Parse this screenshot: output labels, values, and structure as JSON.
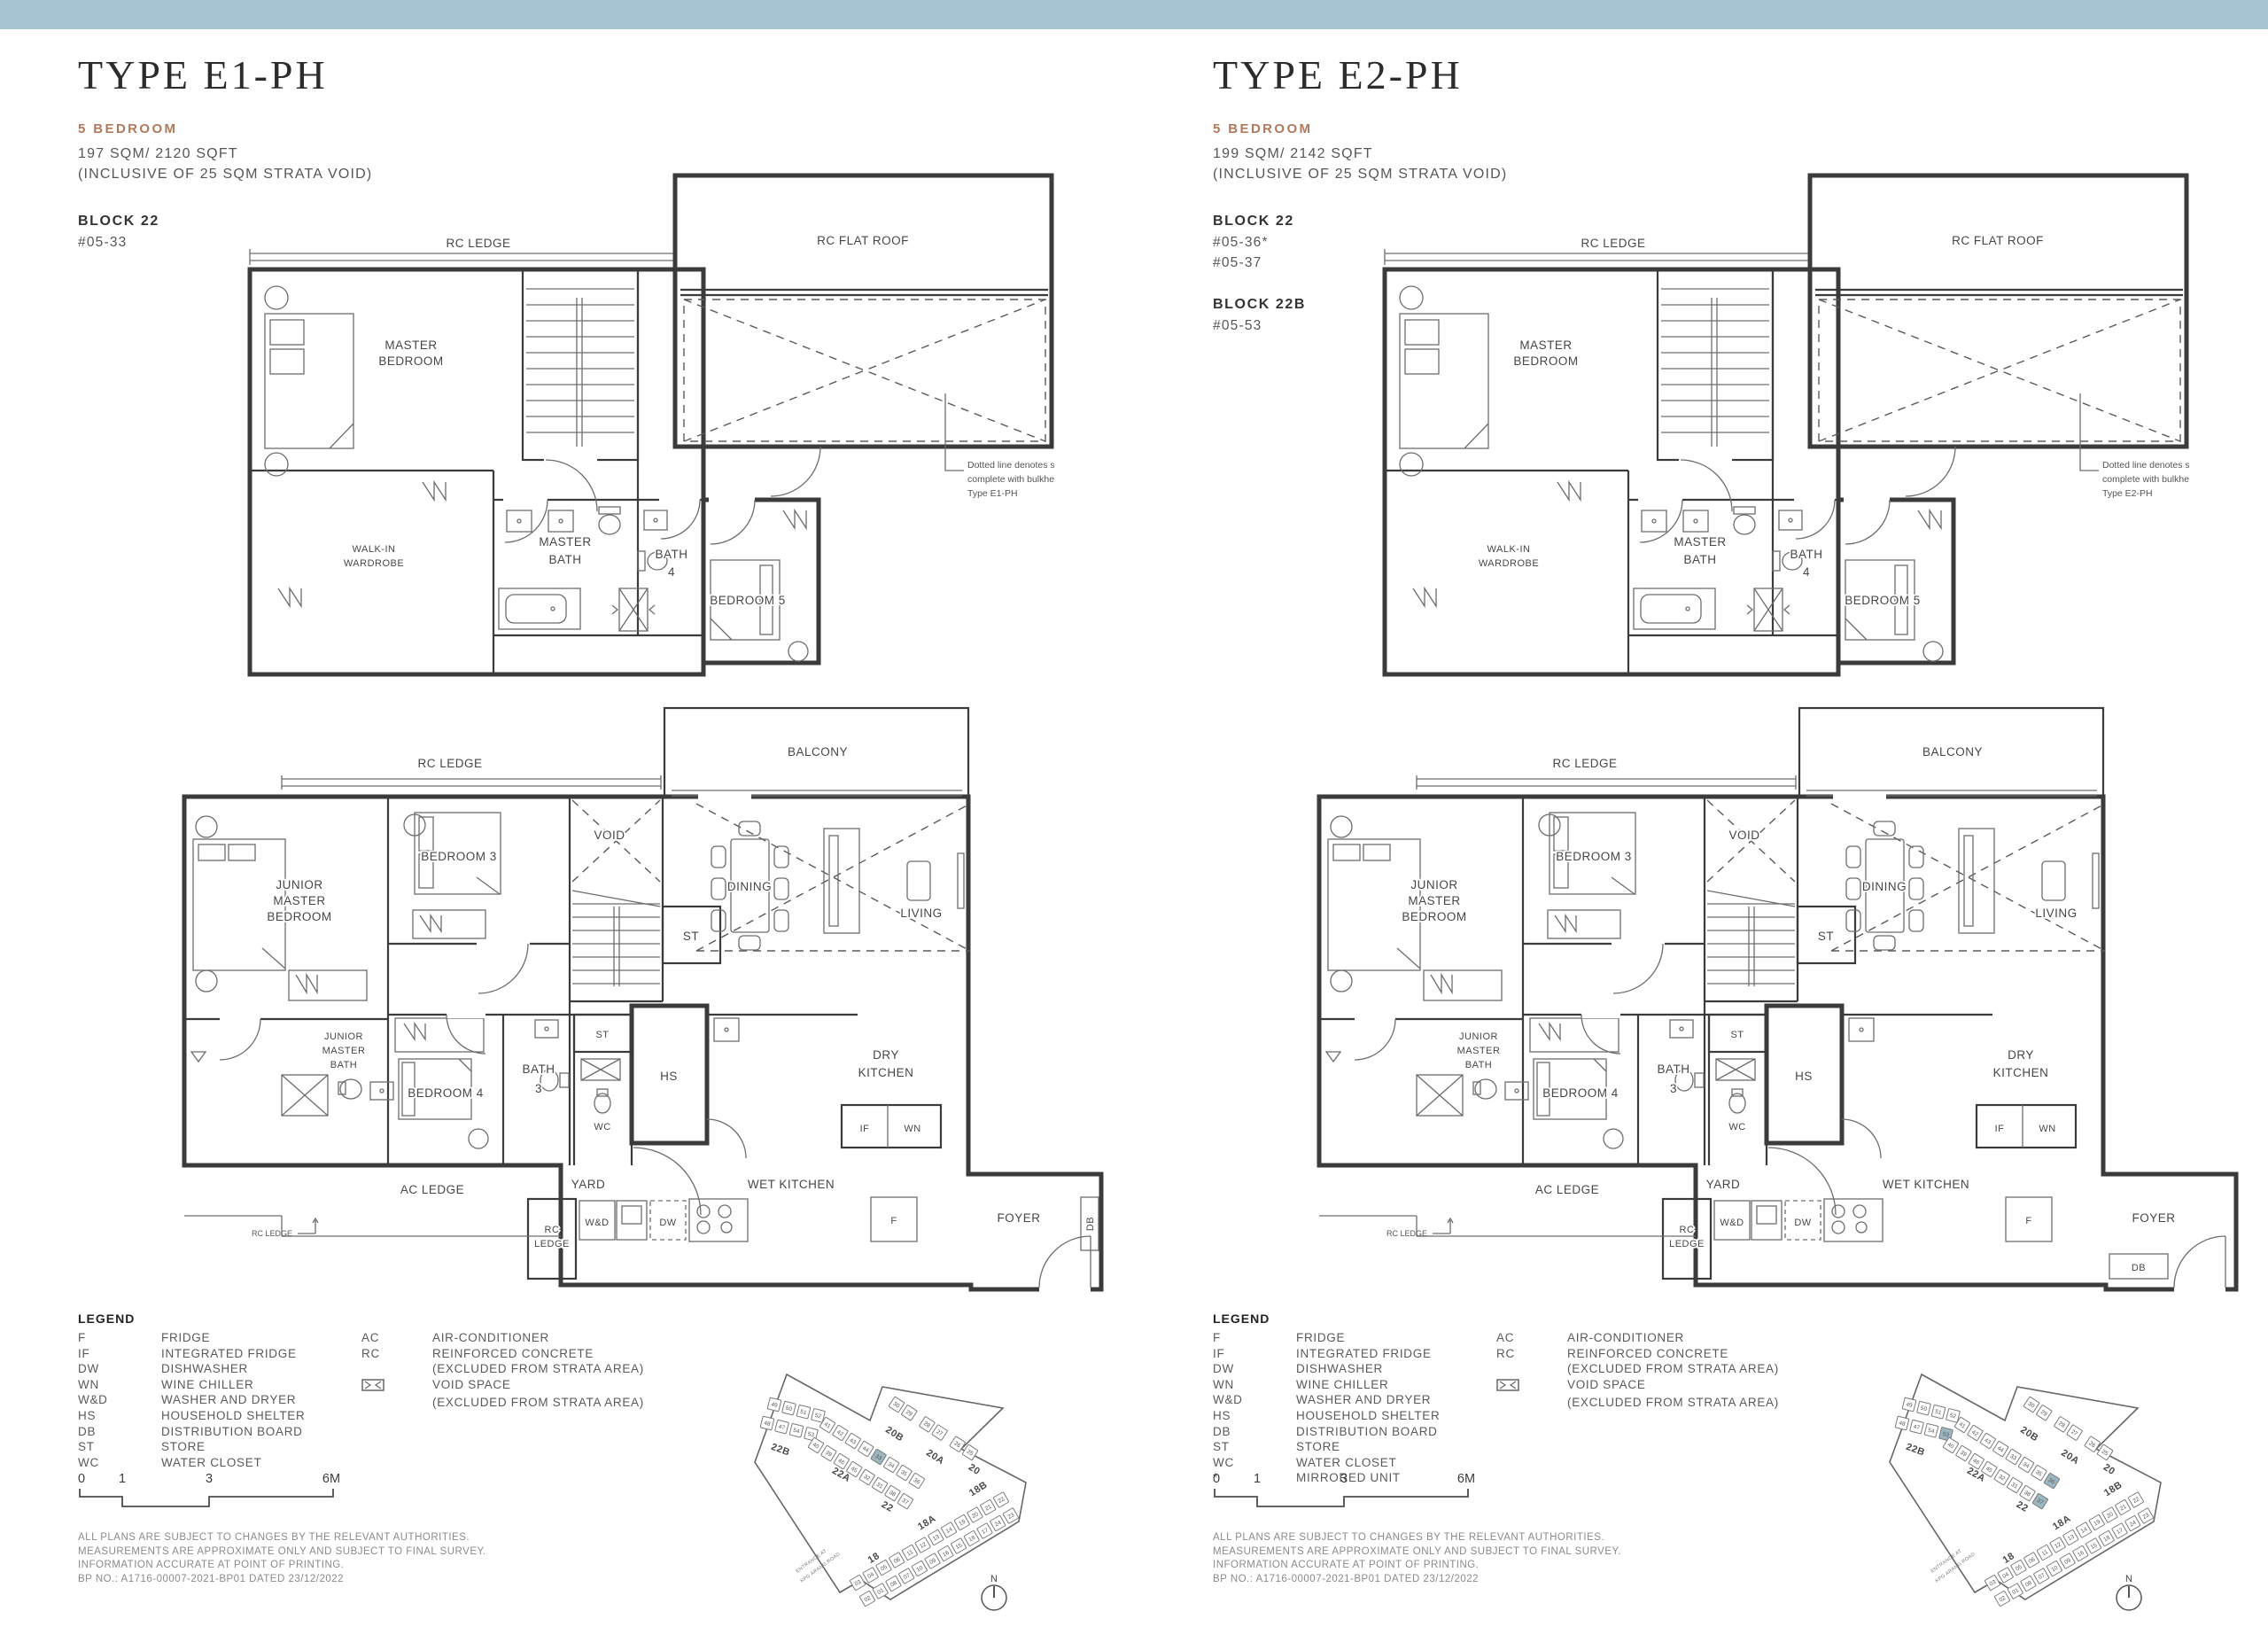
{
  "page": {
    "topbar_color": "#a6c4d2",
    "accent_color": "#b1795b",
    "highlight_color": "#9cb7c1"
  },
  "legend_title": "LEGEND",
  "legend_right": [
    {
      "a": "AC",
      "t": "AIR-CONDITIONER"
    },
    {
      "a": "RC",
      "t": "REINFORCED CONCRETE"
    },
    {
      "a": "",
      "t": "(EXCLUDED FROM STRATA AREA)"
    },
    {
      "a": "",
      "t": "VOID SPACE"
    },
    {
      "a": "",
      "t": "(EXCLUDED FROM STRATA AREA)"
    }
  ],
  "scalebar": [
    "0",
    "1",
    "3",
    "6M"
  ],
  "disclaimer": [
    "ALL PLANS ARE SUBJECT TO CHANGES BY THE RELEVANT AUTHORITIES.",
    "MEASUREMENTS ARE APPROXIMATE ONLY AND SUBJECT TO FINAL SURVEY.",
    "INFORMATION ACCURATE AT POINT OF PRINTING.",
    "BP NO.: A1716-00007-2021-BP01 DATED 23/12/2022"
  ],
  "plan": {
    "upper": {
      "rc_ledge": "RC LEDGE",
      "rc_flat_roof": "RC FLAT ROOF",
      "master_bedroom": [
        "MASTER",
        "BEDROOM"
      ],
      "walk_in_wardrobe": [
        "WALK-IN",
        "WARDROBE"
      ],
      "master_bath": [
        "MASTER",
        "BATH"
      ],
      "bath4": [
        "BATH",
        "4"
      ],
      "bedroom5": "BEDROOM 5"
    },
    "lower": {
      "rc_ledge": "RC LEDGE",
      "balcony": "BALCONY",
      "junior_master_bedroom": [
        "JUNIOR",
        "MASTER",
        "BEDROOM"
      ],
      "bedroom3": "BEDROOM 3",
      "void": "VOID",
      "st_upper": "ST",
      "dining": "DINING",
      "living": "LIVING",
      "junior_master_bath": [
        "JUNIOR",
        "MASTER",
        "BATH"
      ],
      "bedroom4": "BEDROOM 4",
      "bath3": [
        "BATH",
        "3"
      ],
      "st_small": "ST",
      "wc": "WC",
      "hs": "HS",
      "dry_kitchen": [
        "DRY",
        "KITCHEN"
      ],
      "if_label": "IF",
      "wn": "WN",
      "ac_ledge": "AC LEDGE",
      "yard": "YARD",
      "wet_kitchen": "WET KITCHEN",
      "rc_ledge_small": [
        "RC",
        "LEDGE"
      ],
      "rc_ledge_tiny": "RC LEDGE",
      "wd": "W&D",
      "dw": "DW",
      "f": "F",
      "foyer": "FOYER",
      "db": "DB"
    }
  },
  "sitemap": {
    "block_labels": [
      "22B",
      "22A",
      "22",
      "20B",
      "20A",
      "20",
      "18",
      "18A",
      "18B"
    ],
    "stacks": [
      [
        "49",
        "50",
        "51",
        "52"
      ],
      [
        "48",
        "47",
        "54",
        "53"
      ],
      [
        "41",
        "42",
        "43",
        "44",
        "33",
        "34",
        "35",
        "36"
      ],
      [
        "40",
        "39",
        "46",
        "45",
        "32",
        "31",
        "38",
        "37"
      ],
      [
        "30",
        "29",
        "28",
        "27",
        "26",
        "25"
      ],
      [
        "03",
        "04",
        "05",
        "06",
        "11",
        "12",
        "13",
        "14",
        "19",
        "20",
        "21",
        "22"
      ],
      [
        "02",
        "01",
        "08",
        "07",
        "10",
        "09",
        "16",
        "15",
        "18",
        "17",
        "24",
        "23"
      ]
    ],
    "north": "N",
    "entrance": [
      "ENTRANCE AT",
      "KPG ARANG ROAD"
    ]
  },
  "panels": [
    {
      "title": "TYPE E1-PH",
      "bedroom_tag": "5 BEDROOM",
      "area": "197 SQM/ 2120 SQFT",
      "area_note": "(INCLUSIVE OF 25 SQM STRATA VOID)",
      "block1_name": "BLOCK 22",
      "block1_units": [
        "#05-33"
      ],
      "annotation": [
        "Dotted line denotes strata void",
        "complete with bulkhead at",
        "Type E1-PH"
      ],
      "legend_left": [
        {
          "a": "F",
          "t": "FRIDGE"
        },
        {
          "a": "IF",
          "t": "INTEGRATED FRIDGE"
        },
        {
          "a": "DW",
          "t": "DISHWASHER"
        },
        {
          "a": "WN",
          "t": "WINE CHILLER"
        },
        {
          "a": "W&D",
          "t": "WASHER AND DRYER"
        },
        {
          "a": "HS",
          "t": "HOUSEHOLD SHELTER"
        },
        {
          "a": "DB",
          "t": "DISTRIBUTION BOARD"
        },
        {
          "a": "ST",
          "t": "STORE"
        },
        {
          "a": "WC",
          "t": "WATER CLOSET"
        }
      ],
      "sitemap_highlights": [
        "33"
      ]
    },
    {
      "title": "TYPE E2-PH",
      "bedroom_tag": "5 BEDROOM",
      "area": "199 SQM/ 2142 SQFT",
      "area_note": "(INCLUSIVE OF 25 SQM STRATA VOID)",
      "block1_name": "BLOCK 22",
      "block1_units": [
        "#05-36*",
        "#05-37"
      ],
      "block2_name": "BLOCK 22B",
      "block2_units": [
        "#05-53"
      ],
      "annotation": [
        "Dotted line denotes strata void",
        "complete with bulkhead at",
        "Type E2-PH"
      ],
      "legend_left": [
        {
          "a": "F",
          "t": "FRIDGE"
        },
        {
          "a": "IF",
          "t": "INTEGRATED FRIDGE"
        },
        {
          "a": "DW",
          "t": "DISHWASHER"
        },
        {
          "a": "WN",
          "t": "WINE CHILLER"
        },
        {
          "a": "W&D",
          "t": "WASHER AND DRYER"
        },
        {
          "a": "HS",
          "t": "HOUSEHOLD SHELTER"
        },
        {
          "a": "DB",
          "t": "DISTRIBUTION BOARD"
        },
        {
          "a": "ST",
          "t": "STORE"
        },
        {
          "a": "WC",
          "t": "WATER CLOSET"
        },
        {
          "a": "*",
          "t": "MIRRORED UNIT"
        }
      ],
      "sitemap_highlights": [
        "53",
        "36",
        "37"
      ]
    }
  ]
}
